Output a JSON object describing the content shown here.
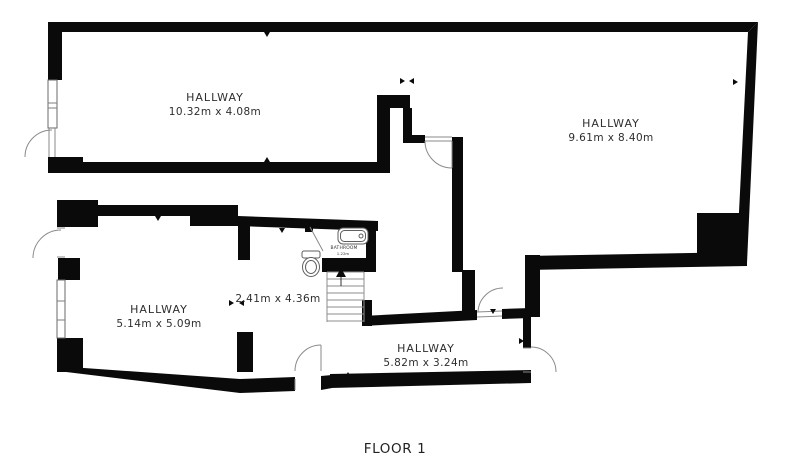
{
  "floor_plan": {
    "title": "FLOOR 1",
    "rooms": [
      {
        "name": "HALLWAY",
        "dimensions": "10.32m x 4.08m"
      },
      {
        "name": "HALLWAY",
        "dimensions": "9.61m x 8.40m"
      },
      {
        "name": "HALLWAY",
        "dimensions": "5.14m x 5.09m"
      },
      {
        "name": "",
        "dimensions": "2.41m x 4.36m"
      },
      {
        "name": "HALLWAY",
        "dimensions": "5.82m x 3.24m"
      },
      {
        "name": "BATHROOM",
        "dimensions": "1.22m"
      }
    ],
    "colors": {
      "wall": "#0a0a0a",
      "door_line": "#8a8a8a",
      "fixture_line": "#5f5f5f",
      "stair_line": "#8d8d8d",
      "text": "#2e2e2e",
      "background": "#ffffff"
    }
  }
}
